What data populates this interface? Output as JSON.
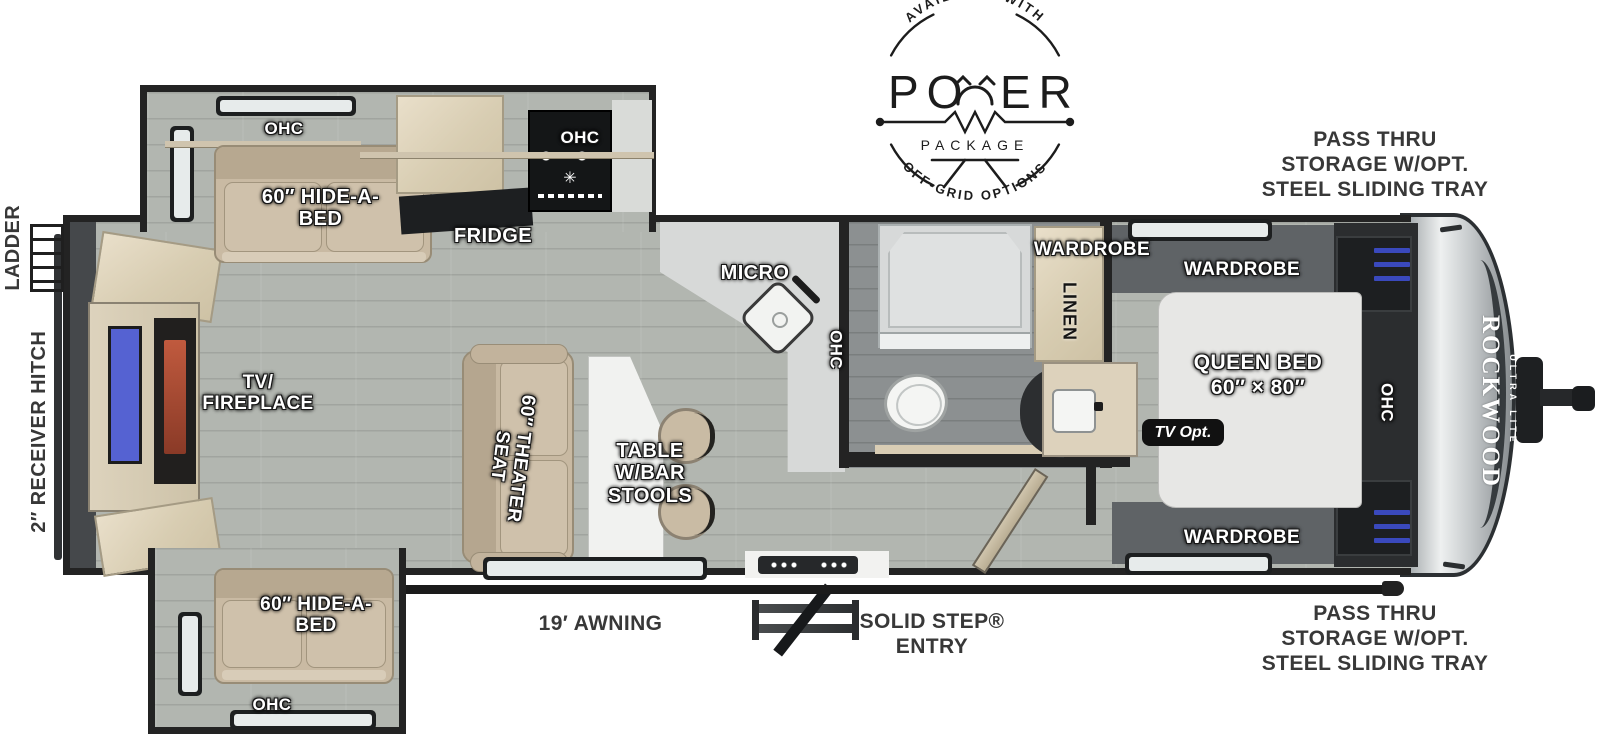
{
  "badge": {
    "top_arc": "AVAILABLE WITH",
    "power_left": "PO",
    "power_right": "ER",
    "package": "PACKAGE",
    "bottom_arc": "OFF-GRID OPTIONS"
  },
  "exterior": {
    "pass_thru_top": "PASS THRU\nSTORAGE W/OPT.\nSTEEL SLIDING TRAY",
    "pass_thru_bottom": "PASS THRU\nSTORAGE W/OPT.\nSTEEL SLIDING TRAY",
    "ladder": "LADDER",
    "receiver_hitch": "2″ RECEIVER HITCH",
    "awning": "19′ AWNING",
    "solid_step": "SOLID STEP®\nENTRY"
  },
  "brand": {
    "name": "ROCKWOOD",
    "sub": "ULTRA LITE"
  },
  "rooms": {
    "ohc_top_slide": "OHC",
    "hide_a_bed_top": "60″ HIDE-A-\nBED",
    "fridge": "FRIDGE",
    "ohc_stove": "OHC",
    "micro": "MICRO",
    "ohc_kitchen": "OHC",
    "wardrobe_bath": "WARDROBE",
    "linen": "LINEN",
    "wardrobe_bed_top": "WARDROBE",
    "queen_bed": "QUEEN BED\n60″ × 80″",
    "tv_opt": "TV Opt.",
    "ohc_bed": "OHC",
    "wardrobe_bed_bottom": "WARDROBE",
    "tv_fireplace": "TV/\nFIREPLACE",
    "theater_seat": "60″ THEATER\nSEAT",
    "table": "TABLE\nW/BAR\nSTOOLS",
    "hide_a_bed_bottom": "60″ HIDE-A-\nBED",
    "ohc_bottom_slide": "OHC"
  },
  "colors": {
    "wall": "#232323",
    "floor": "#b2b6b0",
    "floor_bath": "#8c9091",
    "furniture_tan": "#c9baa3",
    "cabinet_wood": "#e0d6c0",
    "tv_blue": "#5562d2",
    "fireplace_glow": "#b0503a",
    "bed_white": "#e7e7e5",
    "counter": "#d7d9d8",
    "label_white": "#ffffff",
    "label_dark": "#383838",
    "wardrobe_blue": "#3a49bd"
  }
}
